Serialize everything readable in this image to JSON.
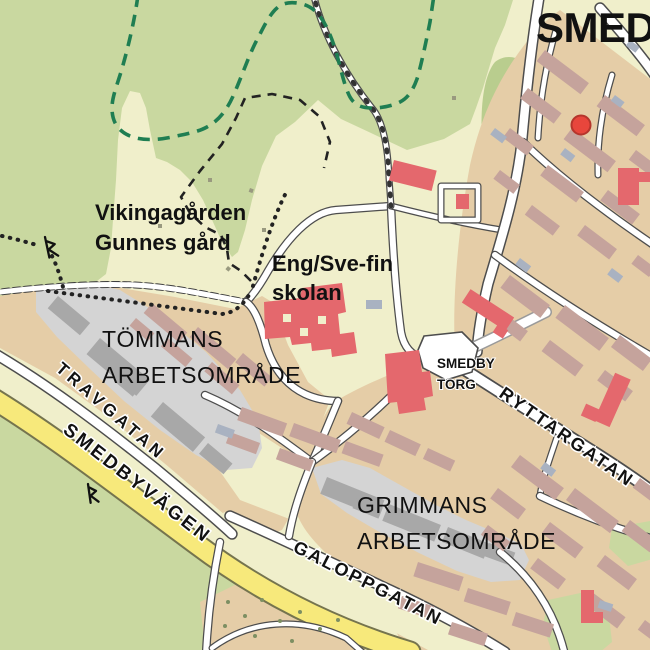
{
  "map": {
    "labels": {
      "title": "SMEDBY",
      "vikinga1": "Vikingagården",
      "vikinga2": "Gunnes gård",
      "school1": "Eng/Sve-fin",
      "school2": "skolan",
      "tommans1": "TÖMMANS",
      "tommans2": "ARBETSOMRÅDE",
      "grimmans1": "GRIMMANS",
      "grimmans2": "ARBETSOMRÅDE",
      "torg1": "SMEDBY",
      "torg2": "TORG"
    },
    "streets": {
      "smedbyvagen": "SMEDBYVÄGEN",
      "travgatan": "TRAVGATAN",
      "galoppgatan": "GALOPPGATAN",
      "ryttargatan": "RYTTARGATAN"
    },
    "icons": {
      "rune_stone": "runestone-icon",
      "marker": "location-marker"
    },
    "colors": {
      "background": "#f0efcb",
      "forest": "#c9d8a0",
      "forest-dark": "#b9cd8e",
      "residential": "#e5cda7",
      "building": "#c5a39c",
      "industrial-area": "#d4d4d4",
      "industrial-building": "#a8a8a8",
      "public-building": "#e4686d",
      "marker": "#e8463c",
      "parking": "#a9b2c1",
      "road-casing": "#4d4d4d",
      "main-road": "#f7e97b",
      "main-road-casing": "#75744e",
      "boundary-green": "#1f7e52",
      "trail": "#222222",
      "label": "#111111"
    }
  }
}
